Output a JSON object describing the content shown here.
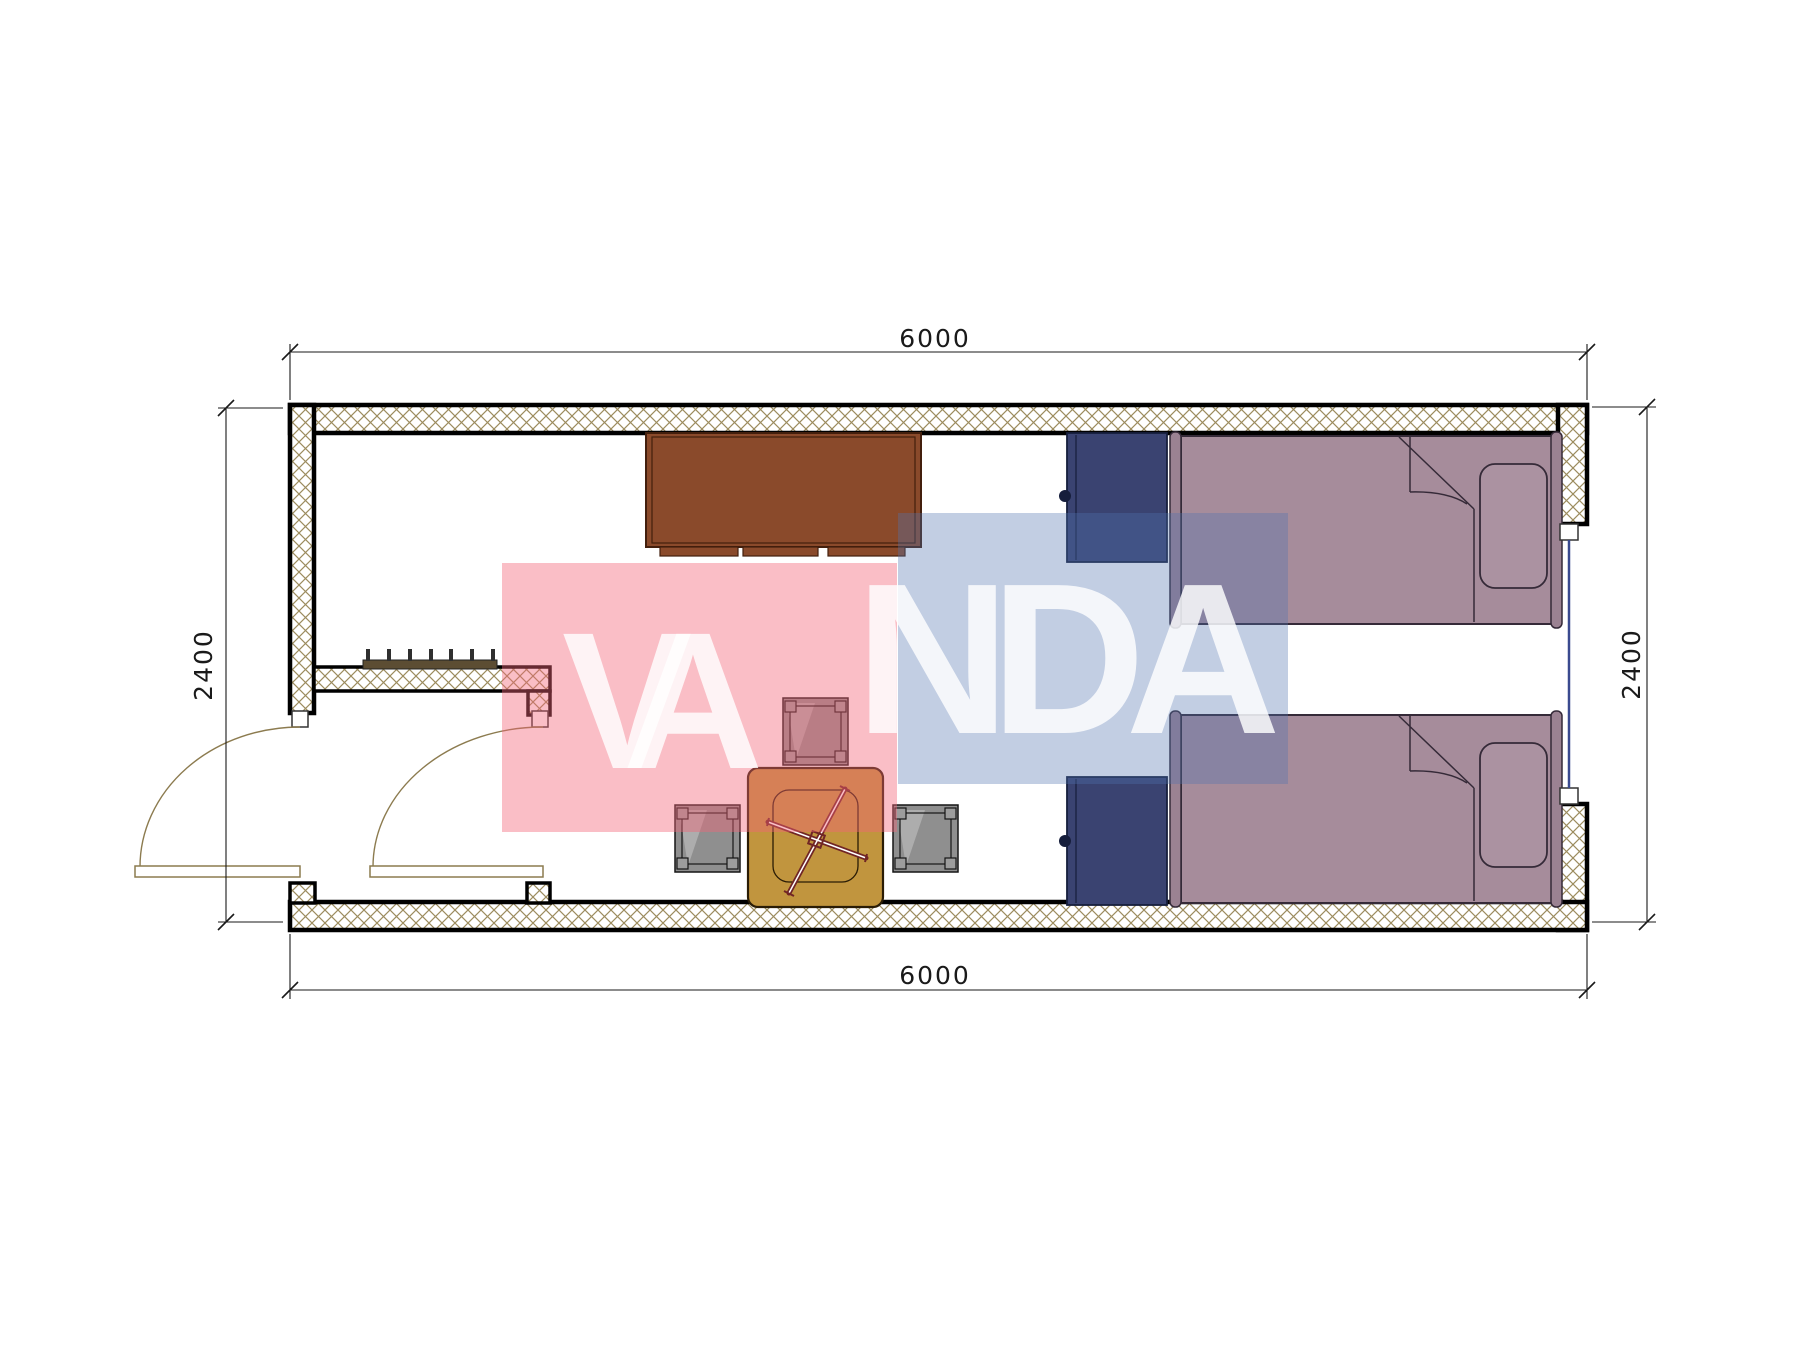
{
  "page": {
    "type": "architectural-floor-plan",
    "background": "#ffffff"
  },
  "watermark": {
    "text": "VANDA",
    "part_1": "VA",
    "part_2": "NDA"
  },
  "dimensions": {
    "top": "6000",
    "bottom": "6000",
    "left": "2400",
    "right": "2400"
  },
  "colors": {
    "ink": "#000000",
    "dim-ink": "#1a1a1a",
    "hatch": "#9c8c5e",
    "bed": "#a68c9b",
    "bed-light": "#ab92a1",
    "bed-dark": "#9b8292",
    "bed-line": "#352a38",
    "navy": "#3a4371",
    "navy-line": "#161e3c",
    "desk": "#8a4a2b",
    "desk-line": "#431f0d",
    "table": "#c1953e",
    "table-line": "#2a1c05",
    "cross": "#702525",
    "stool": "#8f8f8f",
    "stool-line": "#151515",
    "door": "#8c7b4f",
    "window": "#3a4a8f",
    "rack-bar": "#5c4d33",
    "rack-tick": "#2f2f2f",
    "wm-pink": "rgba(242,100,120,0.42)",
    "wm-blue": "rgba(80,115,175,0.35)",
    "wm-text": "rgba(255,255,255,0.82)"
  }
}
